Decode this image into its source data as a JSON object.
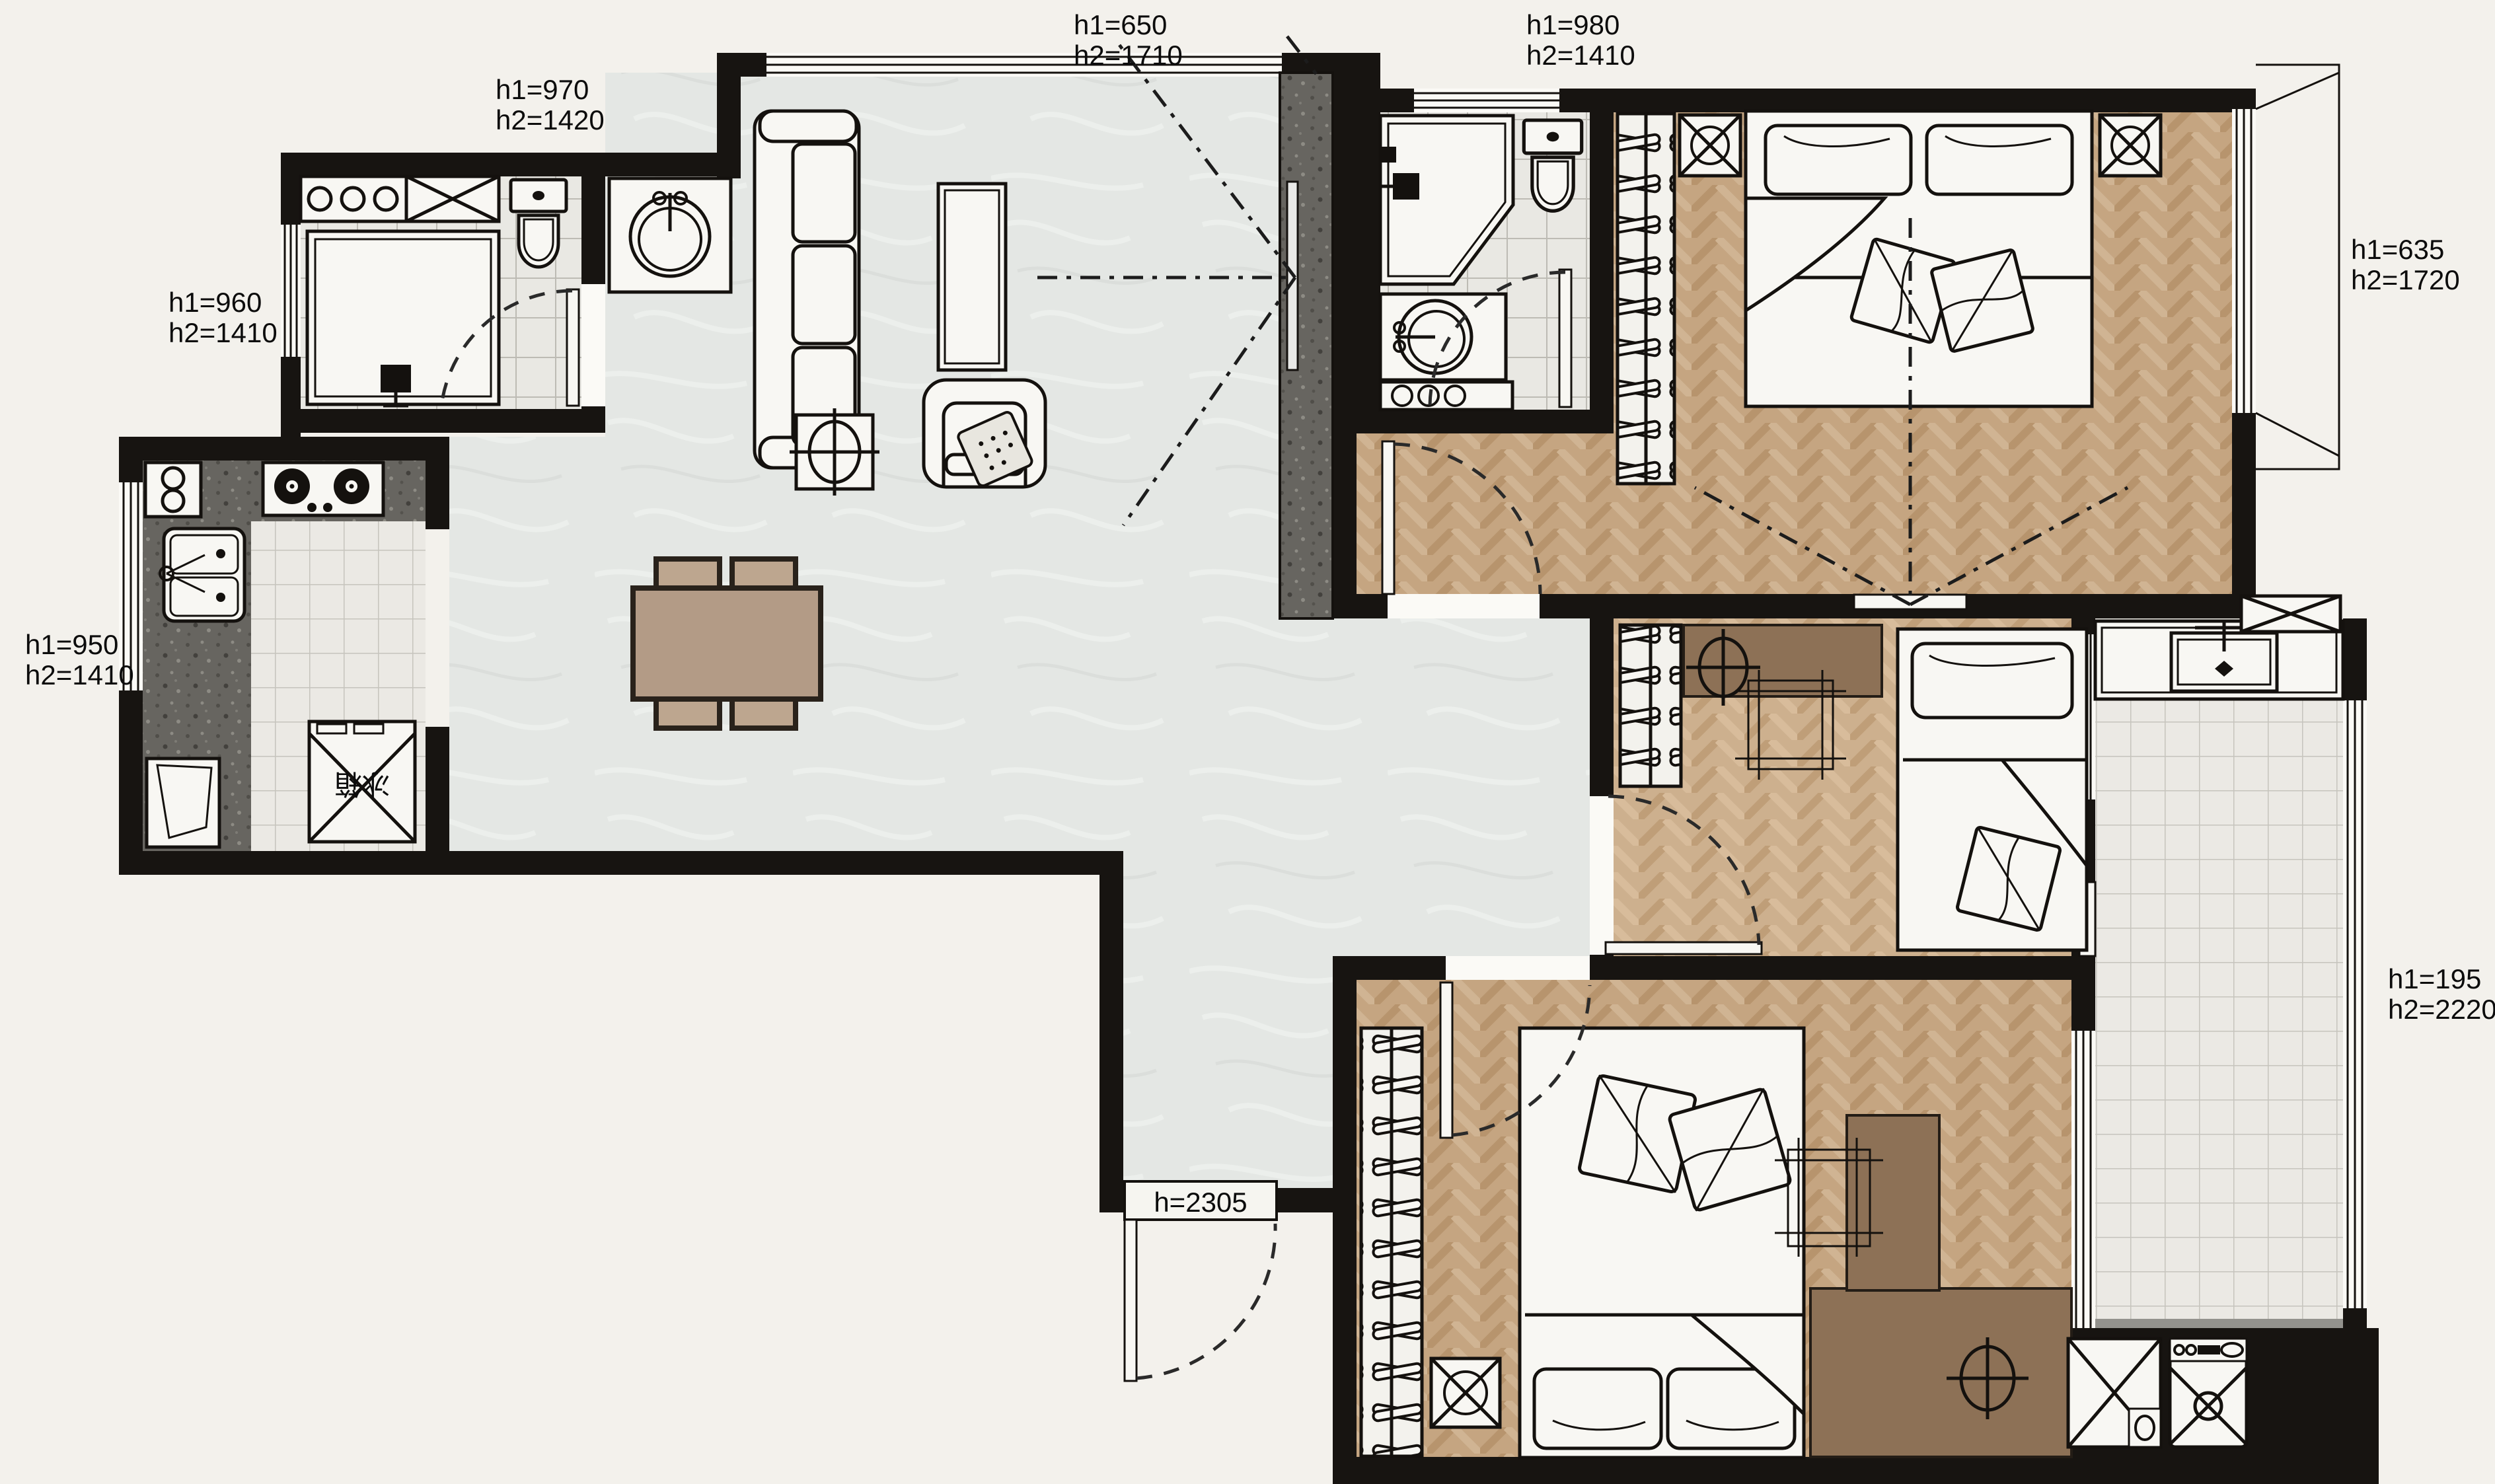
{
  "document": {
    "type": "apartment-floor-plan",
    "units": "mm"
  },
  "colors": {
    "background": "#f3f1ec",
    "wall": "#171411",
    "marble_floor": "#e4e7e4",
    "tile_floor": "#ebe9e4",
    "herringbone_wood": "#c5a581",
    "herringbone_wood_light": "#cdb08e",
    "granite": "#676560",
    "furniture_wood": "#b39b86",
    "dark_wood": "#8d7156",
    "line": "#14110e"
  },
  "labels": {
    "living_window": {
      "l1": "h1=650",
      "l2": "h2=1710"
    },
    "bath2_window": {
      "l1": "h1=980",
      "l2": "h2=1410"
    },
    "bath1_top_window": {
      "l1": "h1=970",
      "l2": "h2=1420"
    },
    "bath1_side_window": {
      "l1": "h1=960",
      "l2": "h2=1410"
    },
    "kitchen_window": {
      "l1": "h1=950",
      "l2": "h2=1410"
    },
    "master_window": {
      "l1": "h1=635",
      "l2": "h2=1720"
    },
    "balcony_window": {
      "l1": "h1=195",
      "l2": "h2=2220"
    },
    "entry_door": {
      "text": "h=2305"
    }
  },
  "appliance_text": {
    "fridge": "冰箱"
  },
  "rooms": {
    "living_dining": {
      "fixtures": [
        "sofa",
        "coffee-table",
        "armchair",
        "side-table-plant",
        "dining-table",
        "four-chairs",
        "tv-feature-wall",
        "tv"
      ]
    },
    "kitchen": {
      "fixtures": [
        "gas-cooktop",
        "double-sink",
        "fridge",
        "under-counter-appliance",
        "granite-counter"
      ]
    },
    "bathroom_main": {
      "fixtures": [
        "shower-tray",
        "toilet",
        "storage-counter",
        "cabinet",
        "door"
      ]
    },
    "vanity_nook": {
      "fixtures": [
        "round-basin-vanity"
      ]
    },
    "bathroom_ensuite": {
      "fixtures": [
        "corner-shower",
        "toilet",
        "round-basin-vanity",
        "storage-strip",
        "door"
      ]
    },
    "master_bedroom": {
      "fixtures": [
        "wardrobe",
        "double-bed",
        "nightstand-left",
        "nightstand-right",
        "tv",
        "window-bay"
      ]
    },
    "middle_bedroom": {
      "fixtures": [
        "wardrobe",
        "desk",
        "chair",
        "plant",
        "single-bed",
        "door",
        "balcony-slider"
      ]
    },
    "bottom_bedroom": {
      "fixtures": [
        "wardrobe",
        "nightstand",
        "double-bed",
        "desk",
        "chair",
        "plant",
        "door"
      ]
    },
    "balcony": {
      "fixtures": [
        "laundry-sink-counter",
        "wall-cabinet",
        "washing-machine",
        "storage-cabinet"
      ]
    }
  }
}
